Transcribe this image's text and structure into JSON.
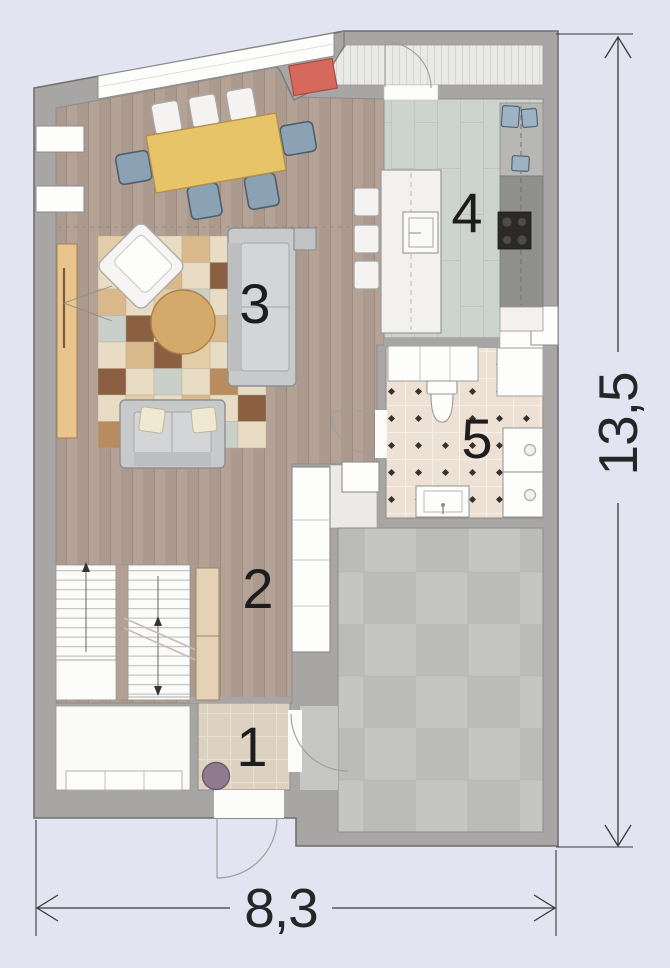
{
  "plan": {
    "type": "architectural-floor-plan",
    "rooms": [
      {
        "number": "1",
        "name": "entry"
      },
      {
        "number": "2",
        "name": "hallway"
      },
      {
        "number": "3",
        "name": "living-room"
      },
      {
        "number": "4",
        "name": "kitchen"
      },
      {
        "number": "5",
        "name": "bathroom"
      }
    ],
    "dimensions": {
      "width_label": "8,3",
      "height_label": "13,5"
    },
    "colors": {
      "background": "#e3e4f2",
      "wall": "#a8a6a4",
      "wood_floor": "#b2a095",
      "kitchen_floor": "#cdd4ce",
      "bathroom_floor": "#ece1d4",
      "entry_floor": "#ddd1c0",
      "garage_floor": "#c5c5c3",
      "terrace_floor": "#e9e9e7",
      "dining_table": "#e8c468",
      "chair_blue": "#8aa2b4",
      "accent_red": "#d4695c",
      "sofa_gray": "#c7c9cb",
      "coffee_table": "#d4aa6a",
      "sideboard": "#e9c48c",
      "pouf_purple": "#8f7b90",
      "dimension_ink": "#2e2e2e",
      "rug_palette": [
        "#e8dcc4",
        "#8a5f42",
        "#d9b98b",
        "#c9cfc9",
        "#e2cda8",
        "#b98c5f"
      ]
    }
  }
}
